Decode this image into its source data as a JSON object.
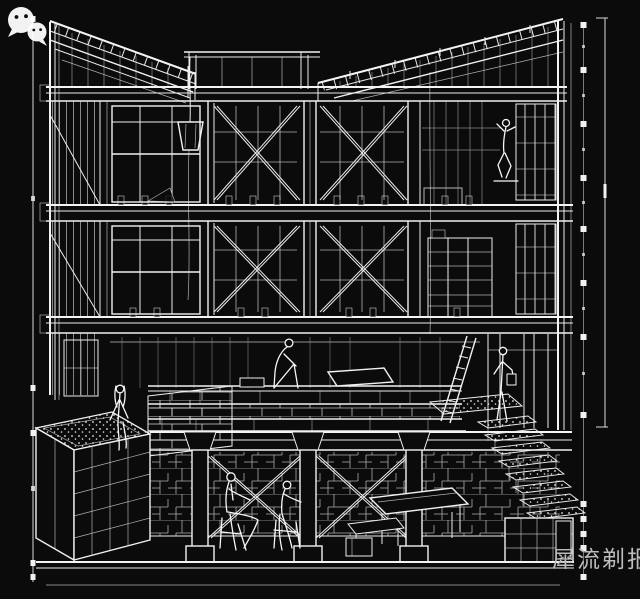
{
  "canvas": {
    "background": "#0b0b0b",
    "line_color": "#efefef",
    "width": 640,
    "height": 599
  },
  "drawing": {
    "type": "architectural-sectional-perspective",
    "style": "white-wireframe-on-black"
  },
  "watermark": {
    "text": "犀流剃报",
    "color": "#bdbdbd",
    "icon": "wechat-icon",
    "icon_color": "#ffffff"
  }
}
